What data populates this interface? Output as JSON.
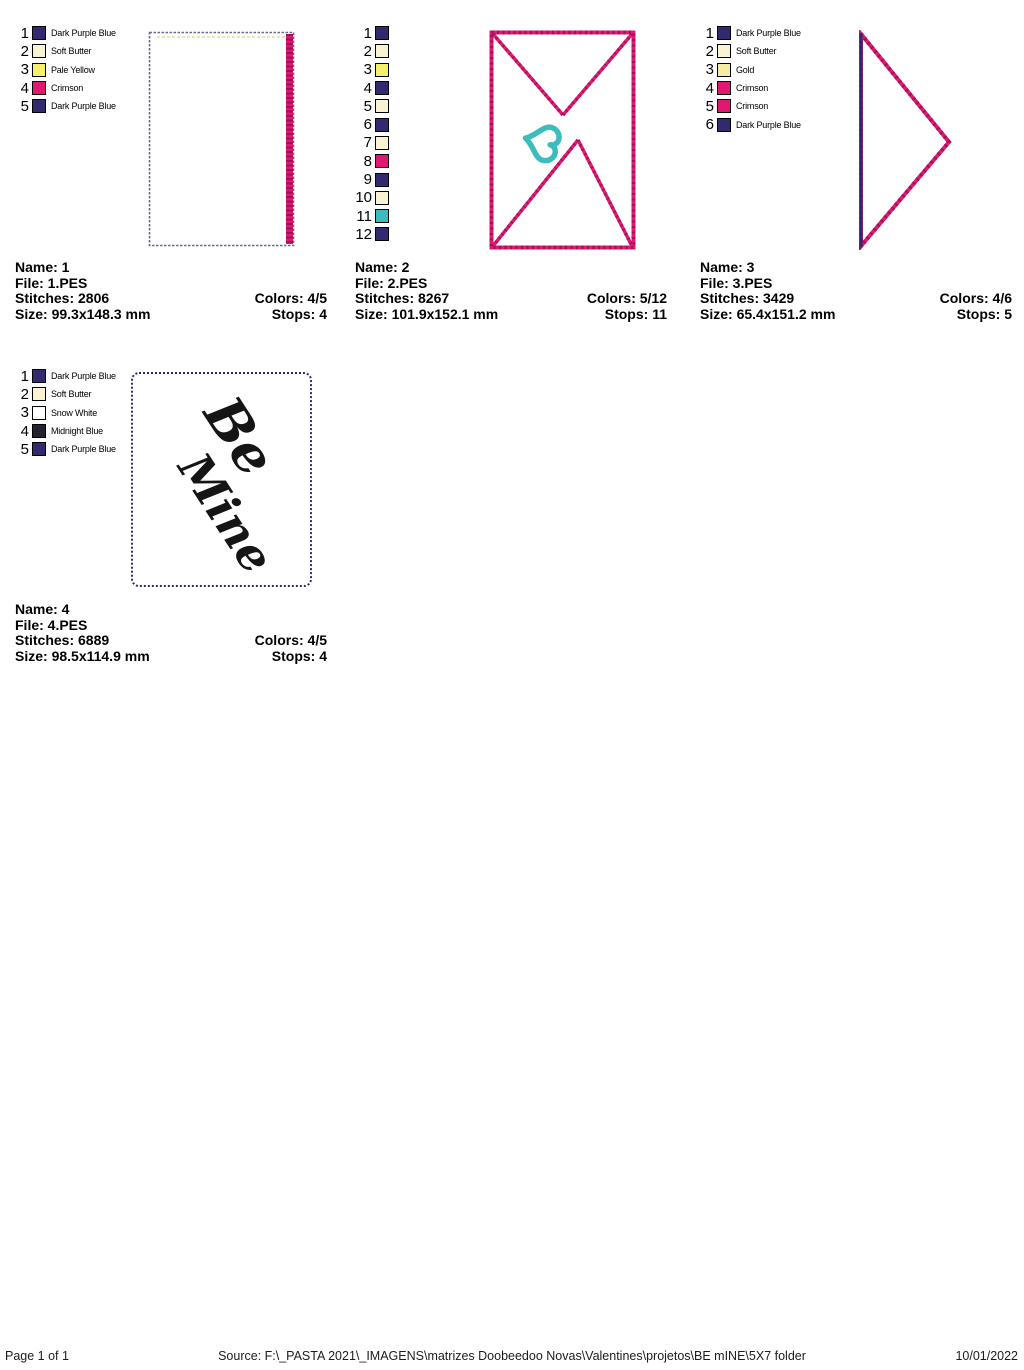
{
  "palette": {
    "dark_purple_blue": "#322a6e",
    "midnight_blue": "#24222f",
    "soft_butter": "#f8f3d2",
    "pale_yellow": "#f6ee6d",
    "gold": "#f4eda4",
    "crimson": "#e01872",
    "crimson_dark": "#9c1457",
    "teal": "#3cbcbe",
    "snow_white": "#ffffff",
    "outline_slate": "#6a6a88",
    "butter_line": "#ece5ae"
  },
  "designs": [
    {
      "threads": [
        {
          "n": "1",
          "label": "Dark Purple Blue",
          "hex": "#322a6e"
        },
        {
          "n": "2",
          "label": "Soft Butter",
          "hex": "#f8f3d2"
        },
        {
          "n": "3",
          "label": "Pale Yellow",
          "hex": "#f6ee6d"
        },
        {
          "n": "4",
          "label": "Crimson",
          "hex": "#e01872"
        },
        {
          "n": "5",
          "label": "Dark Purple Blue",
          "hex": "#322a6e"
        }
      ],
      "info": {
        "name_line": "Name: 1",
        "file_line": "File: 1.PES",
        "stitches_line": "Stitches: 2806",
        "colors_line": "Colors: 4/5",
        "size_line": "Size: 99.3x148.3 mm",
        "stops_line": "Stops: 4"
      }
    },
    {
      "threads": [
        {
          "n": "1",
          "label": "",
          "hex": "#322a6e"
        },
        {
          "n": "2",
          "label": "",
          "hex": "#f8f3d2"
        },
        {
          "n": "3",
          "label": "",
          "hex": "#f6ee6d"
        },
        {
          "n": "4",
          "label": "",
          "hex": "#322a6e"
        },
        {
          "n": "5",
          "label": "",
          "hex": "#f8f3d2"
        },
        {
          "n": "6",
          "label": "",
          "hex": "#322a6e"
        },
        {
          "n": "7",
          "label": "",
          "hex": "#f8f3d2"
        },
        {
          "n": "8",
          "label": "",
          "hex": "#e01872"
        },
        {
          "n": "9",
          "label": "",
          "hex": "#322a6e"
        },
        {
          "n": "10",
          "label": "",
          "hex": "#f8f3d2"
        },
        {
          "n": "11",
          "label": "",
          "hex": "#3cbcbe"
        },
        {
          "n": "12",
          "label": "",
          "hex": "#322a6e"
        }
      ],
      "info": {
        "name_line": "Name: 2",
        "file_line": "File: 2.PES",
        "stitches_line": "Stitches: 8267",
        "colors_line": "Colors: 5/12",
        "size_line": "Size: 101.9x152.1 mm",
        "stops_line": "Stops: 11"
      }
    },
    {
      "threads": [
        {
          "n": "1",
          "label": "Dark Purple Blue",
          "hex": "#322a6e"
        },
        {
          "n": "2",
          "label": "Soft Butter",
          "hex": "#f8f3d2"
        },
        {
          "n": "3",
          "label": "Gold",
          "hex": "#f4eda4"
        },
        {
          "n": "4",
          "label": "Crimson",
          "hex": "#e01872"
        },
        {
          "n": "5",
          "label": "Crimson",
          "hex": "#e01872"
        },
        {
          "n": "6",
          "label": "Dark Purple Blue",
          "hex": "#322a6e"
        }
      ],
      "info": {
        "name_line": "Name: 3",
        "file_line": "File: 3.PES",
        "stitches_line": "Stitches: 3429",
        "colors_line": "Colors: 4/6",
        "size_line": "Size: 65.4x151.2 mm",
        "stops_line": "Stops: 5"
      }
    },
    {
      "threads": [
        {
          "n": "1",
          "label": "Dark Purple Blue",
          "hex": "#322a6e"
        },
        {
          "n": "2",
          "label": "Soft Butter",
          "hex": "#f8f3d2"
        },
        {
          "n": "3",
          "label": "Snow White",
          "hex": "#ffffff"
        },
        {
          "n": "4",
          "label": "Midnight Blue",
          "hex": "#24222f"
        },
        {
          "n": "5",
          "label": "Dark Purple Blue",
          "hex": "#322a6e"
        }
      ],
      "info": {
        "name_line": "Name: 4",
        "file_line": "File: 4.PES",
        "stitches_line": "Stitches: 6889",
        "colors_line": "Colors: 4/5",
        "size_line": "Size: 98.5x114.9 mm",
        "stops_line": "Stops: 4"
      },
      "art": {
        "line1": "Be",
        "line2": "Mine"
      }
    }
  ],
  "footer": {
    "page_label": "Page 1 of 1",
    "source": "Source: F:\\_PASTA 2021\\_IMAGENS\\matrizes Doobeedoo Novas\\Valentines\\projetos\\BE mINE\\5X7 folder",
    "date": "10/01/2022"
  }
}
